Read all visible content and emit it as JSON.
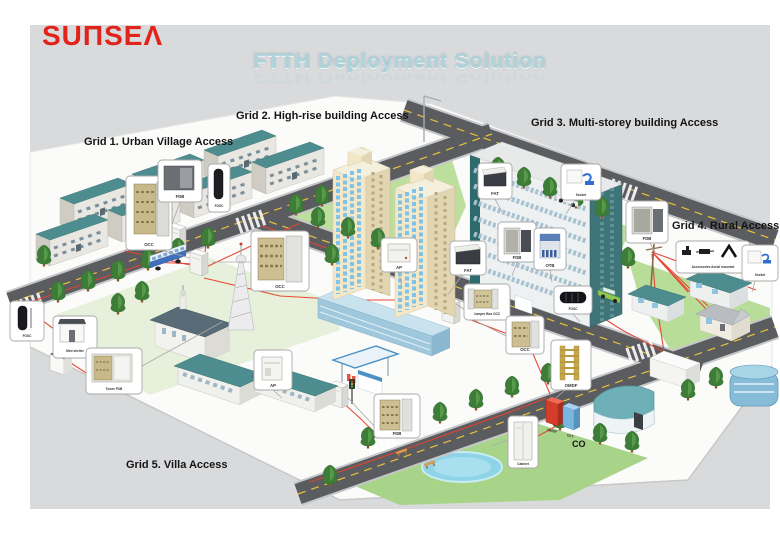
{
  "logo": {
    "text": "SUΠSEΛ"
  },
  "title": "FTTH Deployment Solution",
  "grid_labels": {
    "grid1": "Grid 1. Urban Village Access",
    "grid2": "Grid 2. High-rise building Access",
    "grid3": "Grid 3. Multi-storey building Access",
    "grid4": "Grid 4. Rural Access",
    "grid5": "Grid 5. Villa Access"
  },
  "site_labels": {
    "co": "CO",
    "omdf_tower": "OMDF",
    "olt_tower": "OLT"
  },
  "equipment_labels": {
    "occ": "OCC",
    "fdb": "FDB",
    "fosc": "FOSC",
    "ap": "AP",
    "fat": "FAT",
    "socket": "Socket",
    "otb": "OTB",
    "omdf": "OMDF",
    "cabinet": "Cabinet",
    "jumper_box_occ": "Jumper Box OCC",
    "mini_shelter": "Mini shelter",
    "tower_fdb": "Tower FDB",
    "aerial_accessories": "Accessories Aerial mounted"
  },
  "colors": {
    "brand_red": "#e0241c",
    "title_blue": "#aed3da",
    "fiber_red": "#e8402e",
    "roof_teal": "#4e8d8f",
    "panel_gray": "#d9dadc"
  }
}
